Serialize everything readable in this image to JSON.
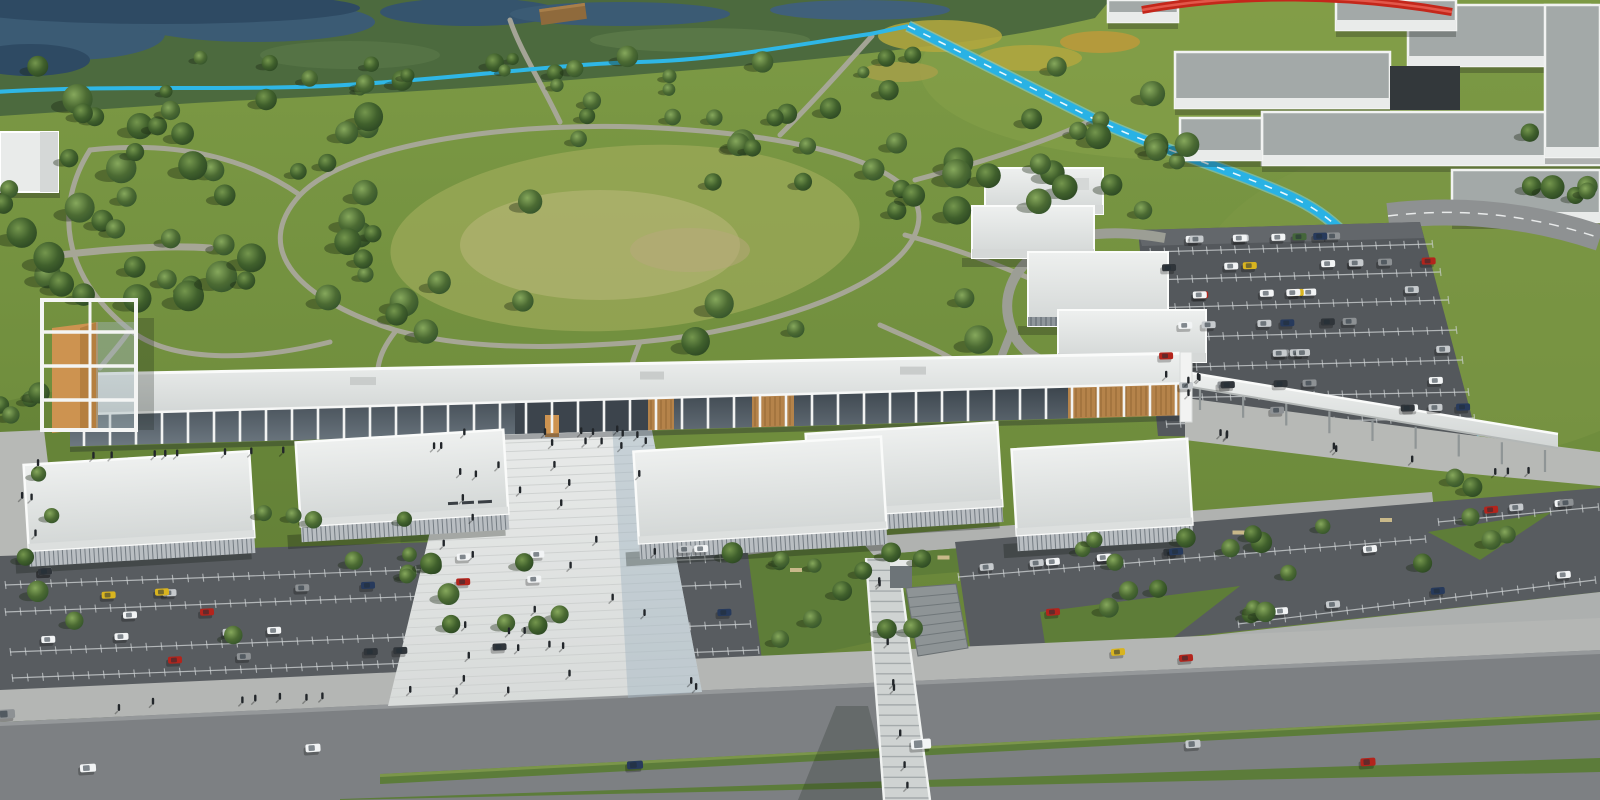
{
  "scene": {
    "description": "Aerial 3D architectural rendering of a long linear shopping and cultural center beside a large tree-filled public park, with a central stepped pedestrian plaza, surface parking lots full of cars, a boulevard with planted medians, a pedestrian overpass bridge, a cyan stream and bike path, and white massing-model buildings in the background",
    "view": "bird's-eye aerial",
    "time_of_day": "day"
  },
  "areas": {
    "park": {
      "label": "Public park with meadow, winding paths and trees"
    },
    "wetland": {
      "label": "Wetland and river at the top edge"
    },
    "stream": {
      "label": "Cyan stream / bike path"
    },
    "campus": {
      "label": "White massing-model buildings (context)"
    },
    "red_structure": {
      "label": "Red tubular structure at top edge"
    },
    "main_building": {
      "label": "Long linear shopping center with colonnade"
    },
    "tower": {
      "label": "Observation tower with orange panel"
    },
    "canopy": {
      "label": "Covered walkway canopy to east parking"
    },
    "pavilions": {
      "label": "White retail pavilions"
    },
    "plaza": {
      "label": "Central stepped pedestrian plaza"
    },
    "parking_north": {
      "label": "North-east surface parking lot"
    },
    "parking_sw": {
      "label": "South-west surface parking lot"
    },
    "parking_se": {
      "label": "South-east surface parking lot"
    },
    "road": {
      "label": "Boulevard with green medians"
    },
    "bridge": {
      "label": "Pedestrian overpass bridge"
    },
    "sign": {
      "label": "Storefront sign (illegible at this scale)"
    }
  },
  "palette": {
    "grass_base": "#72903f",
    "grass_dark": "#5d7c33",
    "grass_light": "#8aa24c",
    "meadow": "#a9b160",
    "meadow_pale": "#bdba7e",
    "marsh": "#4c6a3e",
    "water": "#3b5b74",
    "water_dark": "#2e4a63",
    "tree_light": "#7da154",
    "tree_mid": "#47672f",
    "tree_dark": "#2f4a24",
    "trunk": "#d6dacd",
    "path": "#a9a89b",
    "stream": "#29b2e4",
    "stream_glint": "#cfeffb",
    "asphalt": "#54585c",
    "lot_line": "#d0d4d6",
    "road": "#7d8083",
    "sidewalk": "#b4b6b4",
    "pavement": "#b7b9b6",
    "roof_white": "#e9ebea",
    "roof_grey": "#a3a9a8",
    "facade_white": "#f2f3f2",
    "face_shade": "#d5d8d7",
    "glass": "#4a545c",
    "wood": "#b5834a",
    "orange": "#cd9350",
    "plaza": "#e3e5e4",
    "plaza_line": "#cdd0cf",
    "plaza_shade": "#9fb4c2",
    "red_structure": "#c4271b",
    "people": "#22262a",
    "bench": "#c9b98a",
    "car_colors": [
      "#f2f4f5",
      "#c6cacd",
      "#8d9194",
      "#30353a",
      "#273a5c",
      "#b3241c",
      "#d9b41f",
      "#44663a"
    ]
  }
}
